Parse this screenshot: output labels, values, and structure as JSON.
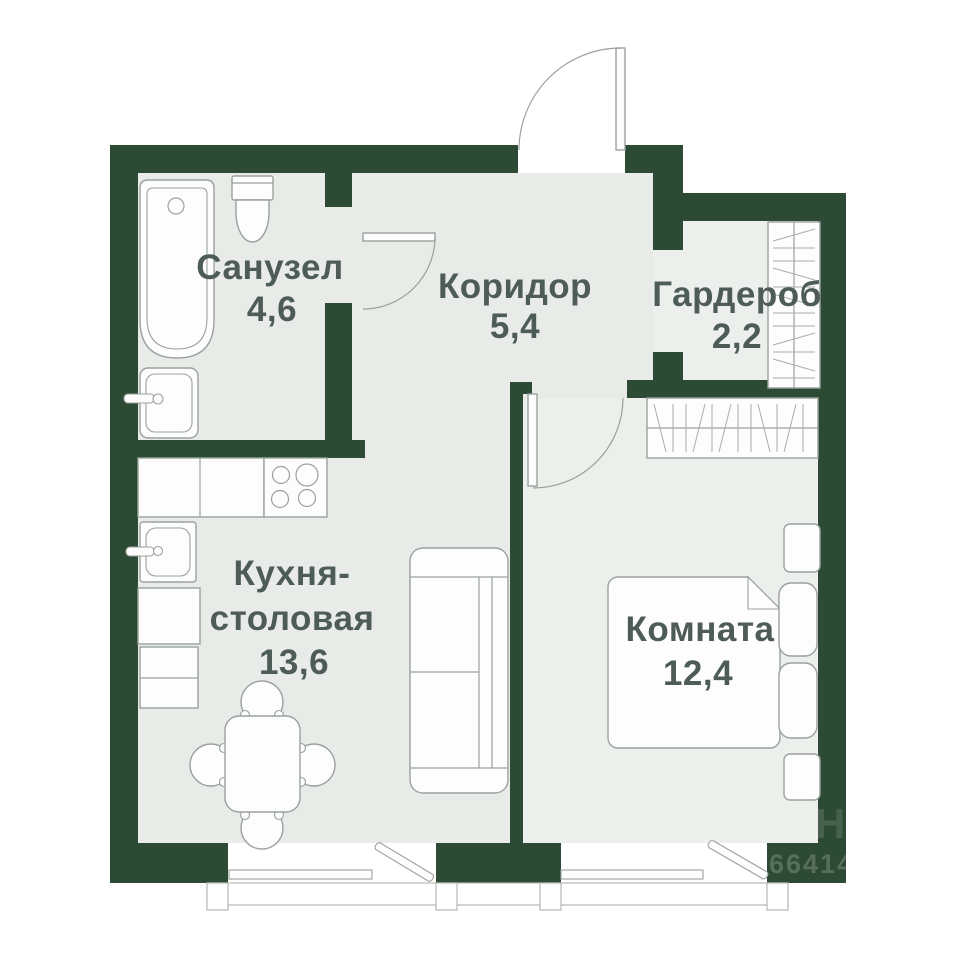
{
  "plan": {
    "rooms": [
      {
        "name": "Санузел",
        "area": "4,6"
      },
      {
        "name": "Коридор",
        "area": "5,4"
      },
      {
        "name": "Гардероб",
        "area": "2,2"
      },
      {
        "name_line1": "Кухня-",
        "name_line2": "столовая",
        "area": "13,6"
      },
      {
        "name": "Комната",
        "area": "12,4"
      }
    ],
    "watermark": {
      "number": "66414",
      "ghost_letter": "Н"
    },
    "colors": {
      "wall": "#2d4a34",
      "floor": "#e9ebe8",
      "floor_light": "#edefec",
      "outline": "#9aa29d",
      "label": "#4e5c57",
      "background": "#ffffff"
    }
  }
}
